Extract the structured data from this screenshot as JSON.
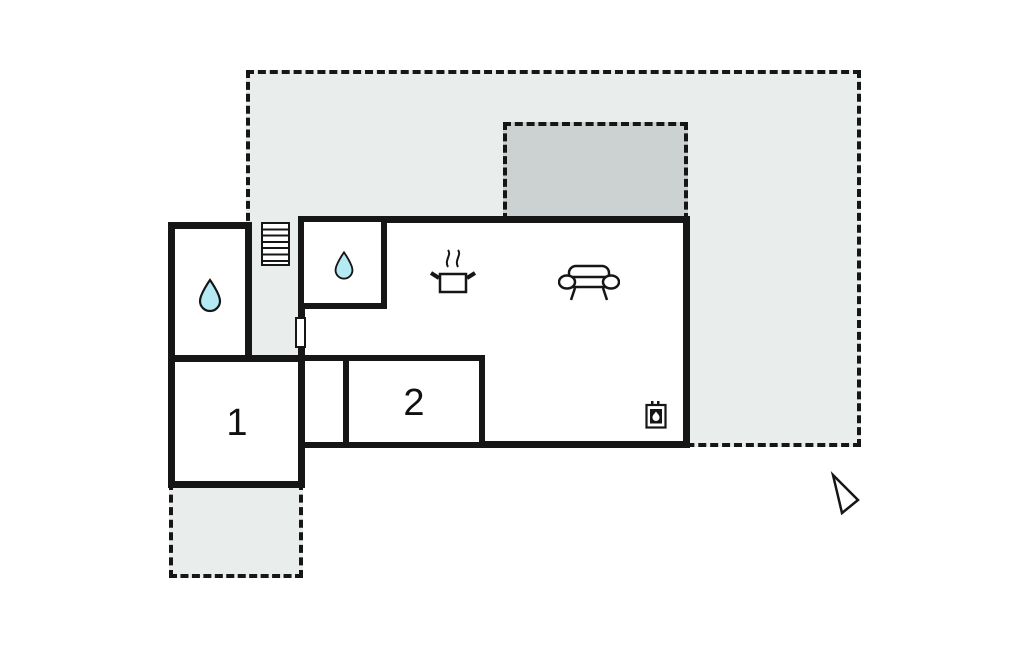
{
  "title": "Holiday home floor plan",
  "rooms": {
    "room1": {
      "label": "1"
    },
    "room2": {
      "label": "2"
    }
  },
  "icons": [
    "water-drop-icon (annex bathroom)",
    "water-drop-icon (main bathroom)",
    "stairs-icon",
    "cooking-pot-icon (kitchen)",
    "sofa-icon (living room)",
    "wood-stove-icon (fireplace)",
    "door-opening-marker",
    "north-arrow-icon"
  ],
  "colors": {
    "wall": "#161616",
    "terrace": "#e9edec",
    "canopy": "#ccd2d2",
    "water": "#b5e9f3",
    "background": "#ffffff"
  }
}
